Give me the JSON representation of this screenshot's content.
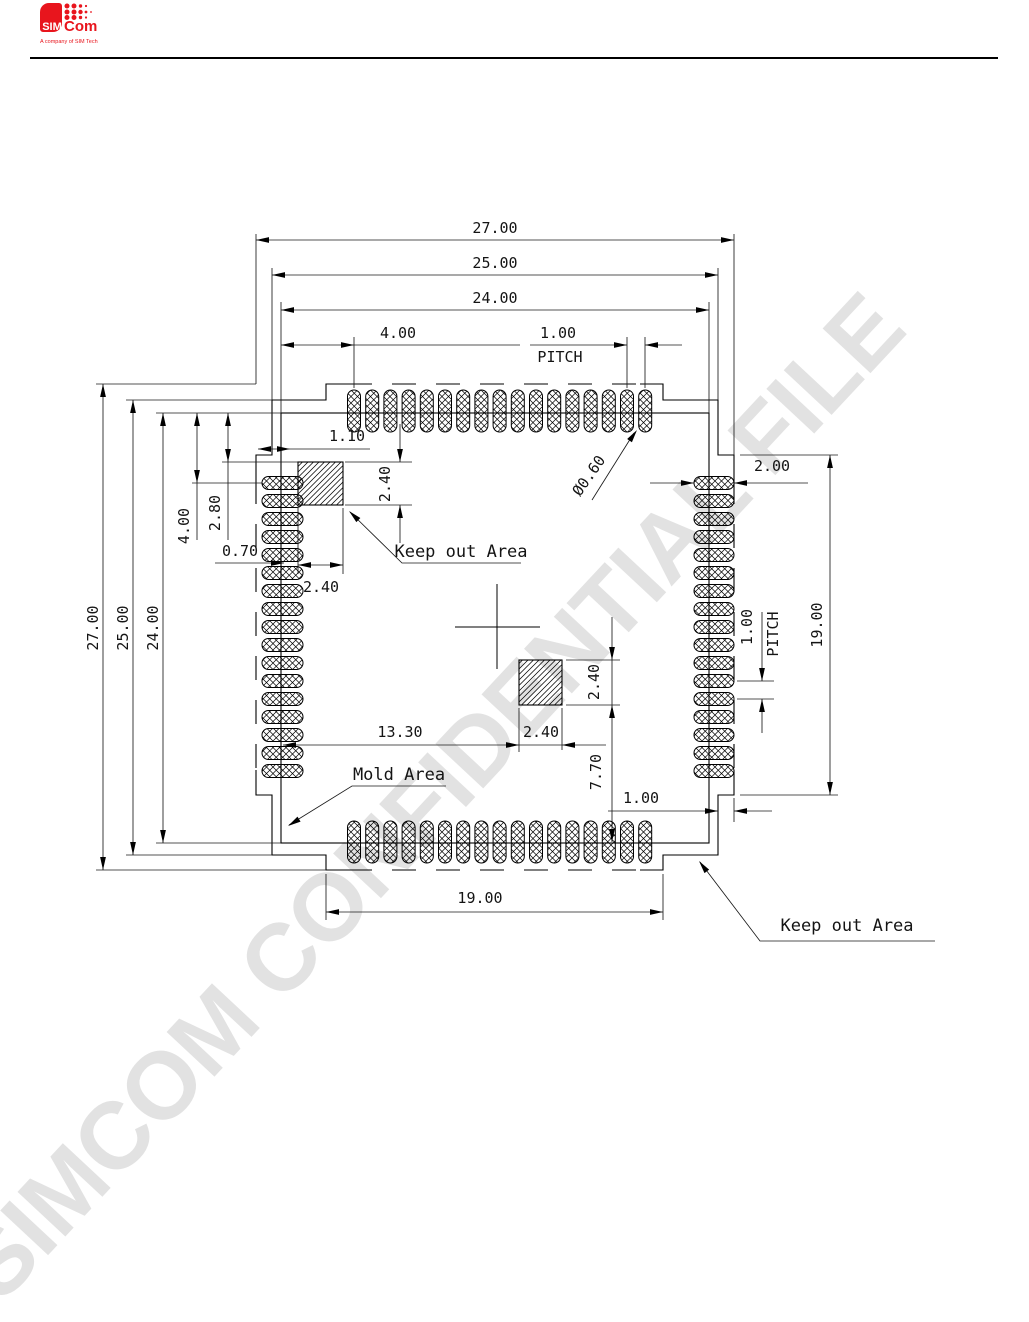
{
  "header": {
    "logo": {
      "sim": "SIM",
      "com": "Com",
      "tagline": "A company of SIM Tech"
    }
  },
  "watermark": "SIMCOM  CONFIDENTIAL FILE",
  "drawing": {
    "dimensions": {
      "top_width_outer": "27.00",
      "top_width_mid": "25.00",
      "top_width_inner": "24.00",
      "top_first_pad_offset": "4.00",
      "top_pitch": "1.00",
      "top_pitch_label": "PITCH",
      "left_height_outer": "27.00",
      "left_height_mid": "25.00",
      "left_height_inner": "24.00",
      "left_first_pad_offset": "4.00",
      "keepout1_top_offset": "2.80",
      "pad_edge_offset": "0.70",
      "keepout1_width": "2.40",
      "keepout1_height": "2.40",
      "pad_inset": "1.10",
      "pad_hole_diameter": "Ø0.60",
      "right_pad_length": "2.00",
      "right_edge_span": "19.00",
      "right_pitch": "1.00",
      "right_pitch_label": "PITCH",
      "keepout2_offset_x": "13.30",
      "keepout2_width": "2.40",
      "keepout2_height": "2.40",
      "keepout2_bottom_offset": "7.70",
      "bottom_corner_step": "1.00",
      "bottom_edge_span": "19.00"
    },
    "labels": {
      "keep_out_area_top": "Keep out Area",
      "mold_area": "Mold Area",
      "keep_out_area_bottom": "Keep out Area"
    }
  }
}
